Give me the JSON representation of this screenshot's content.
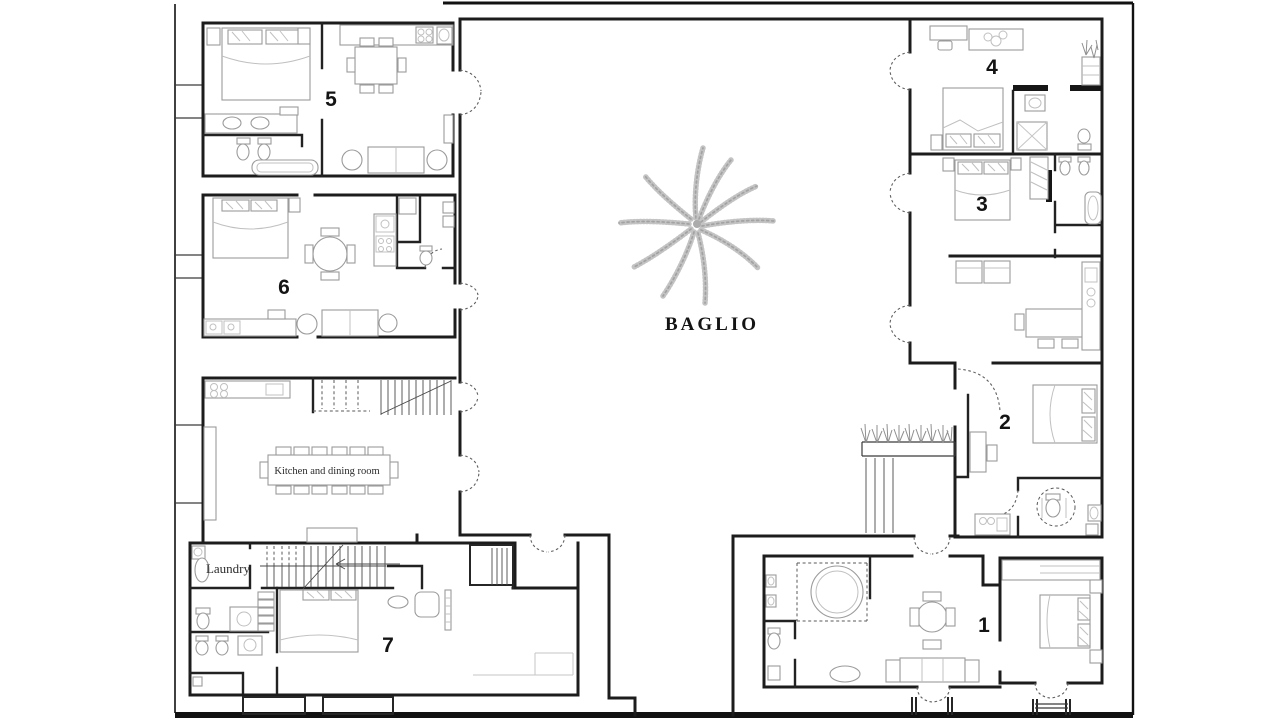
{
  "document": {
    "type": "architectural floor plan (scanned drawing)",
    "title": "BAGLIO"
  },
  "courtyard": {
    "label": "BAGLIO"
  },
  "apartments": [
    {
      "id": "apartment-1",
      "number": "1"
    },
    {
      "id": "apartment-2",
      "number": "2"
    },
    {
      "id": "apartment-3",
      "number": "3"
    },
    {
      "id": "apartment-4",
      "number": "4"
    },
    {
      "id": "apartment-5",
      "number": "5"
    },
    {
      "id": "apartment-6",
      "number": "6"
    },
    {
      "id": "apartment-7",
      "number": "7"
    }
  ],
  "rooms": {
    "kitchen_dining": "Kitchen and dining room",
    "laundry": "Laundry"
  },
  "colors": {
    "background": "#ffffff",
    "wall": "#1c1c1c",
    "furniture_line": "#9b9b9b",
    "sketch": "#b5b5b5"
  }
}
